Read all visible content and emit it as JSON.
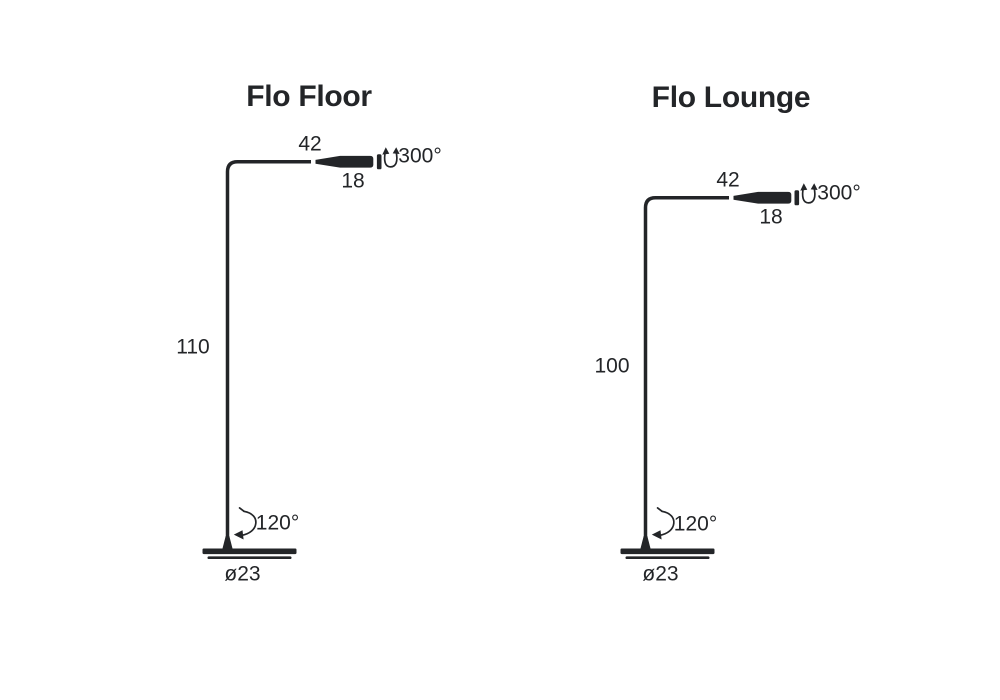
{
  "page": {
    "background_color": "#ffffff",
    "ink_color": "#232528"
  },
  "lamps": [
    {
      "title": "Flo Floor",
      "dimensions": {
        "arm_length": "42",
        "head_depth": "18",
        "head_rotation": "300°",
        "pole_height": "110",
        "base_rotation": "120°",
        "base_diameter": "ø23"
      }
    },
    {
      "title": "Flo Lounge",
      "dimensions": {
        "arm_length": "42",
        "head_depth": "18",
        "head_rotation": "300°",
        "pole_height": "100",
        "base_rotation": "120°",
        "base_diameter": "ø23"
      }
    }
  ]
}
